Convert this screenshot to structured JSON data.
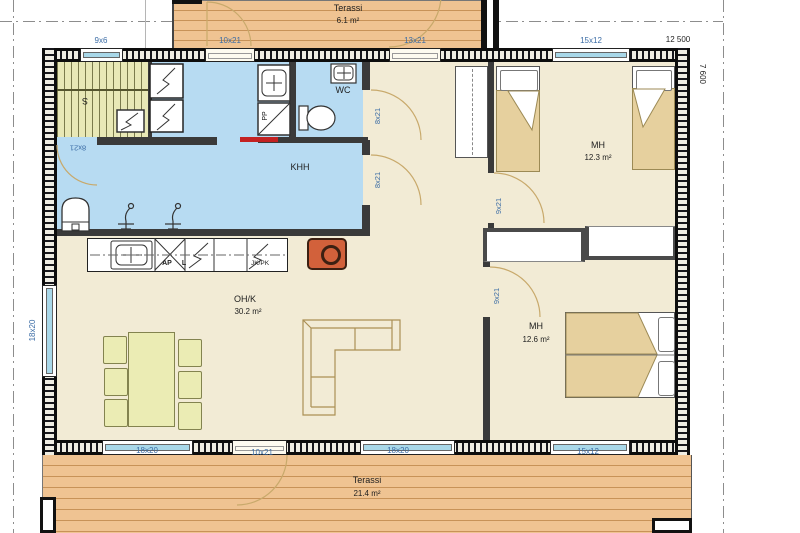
{
  "terraces": {
    "top": {
      "label": "Terassi",
      "area": "6.1 m²"
    },
    "bottom": {
      "label": "Terassi",
      "area": "21.4 m²"
    }
  },
  "rooms": {
    "sauna": {
      "label": "S",
      "door": "8x21"
    },
    "wc": {
      "label": "WC",
      "door": "8x21"
    },
    "khh": {
      "label": "KHH",
      "door": "8x21"
    },
    "pp": {
      "label": "PP"
    },
    "living_kitchen": {
      "label": "OH/K",
      "area": "30.2 m²"
    },
    "bedroom1": {
      "label": "MH",
      "area": "12.3 m²",
      "door": "9x21"
    },
    "bedroom2": {
      "label": "MH",
      "area": "12.6 m²",
      "door": "9x21"
    }
  },
  "kitchen_appliances": {
    "dishwasher_label": "AP",
    "stove_label": "L",
    "fridge_label": "JK/PK"
  },
  "dimensions": {
    "overall_width": "12 500",
    "overall_depth": "7 600",
    "top_openings": [
      "9x6",
      "10x21",
      "13x21",
      "15x12"
    ],
    "bottom_openings": [
      "18x20",
      "10x21",
      "18x20",
      "15x12"
    ],
    "left_openings": [
      "18x20"
    ]
  },
  "colors": {
    "floor": "#f2ebd5",
    "wet_room": "#b7dbf2",
    "terrace_wood": "#efc392",
    "window_glass": "#a9d8e9",
    "fireplace": "#d2613b",
    "furniture": "#ebecb4",
    "bed_blanket": "#e6d09e",
    "dimension_text": "#3b6ca5"
  }
}
